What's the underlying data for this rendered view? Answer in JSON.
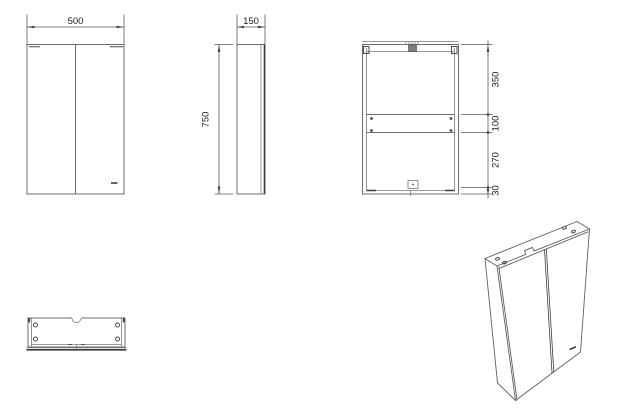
{
  "drawing": {
    "title": "cabinet-technical-drawing",
    "units_note": "",
    "colors": {
      "background": "#ffffff",
      "line": "#6b6b6b",
      "line_dark": "#3f3f3f",
      "text": "#1c1c1c"
    },
    "views": {
      "front": {
        "dim_width": "500"
      },
      "side": {
        "dim_depth": "150",
        "dim_height": "750"
      },
      "back": {
        "dim_segments": [
          "350",
          "100",
          "270",
          "30"
        ]
      },
      "bottom": {},
      "perspective": {}
    }
  }
}
